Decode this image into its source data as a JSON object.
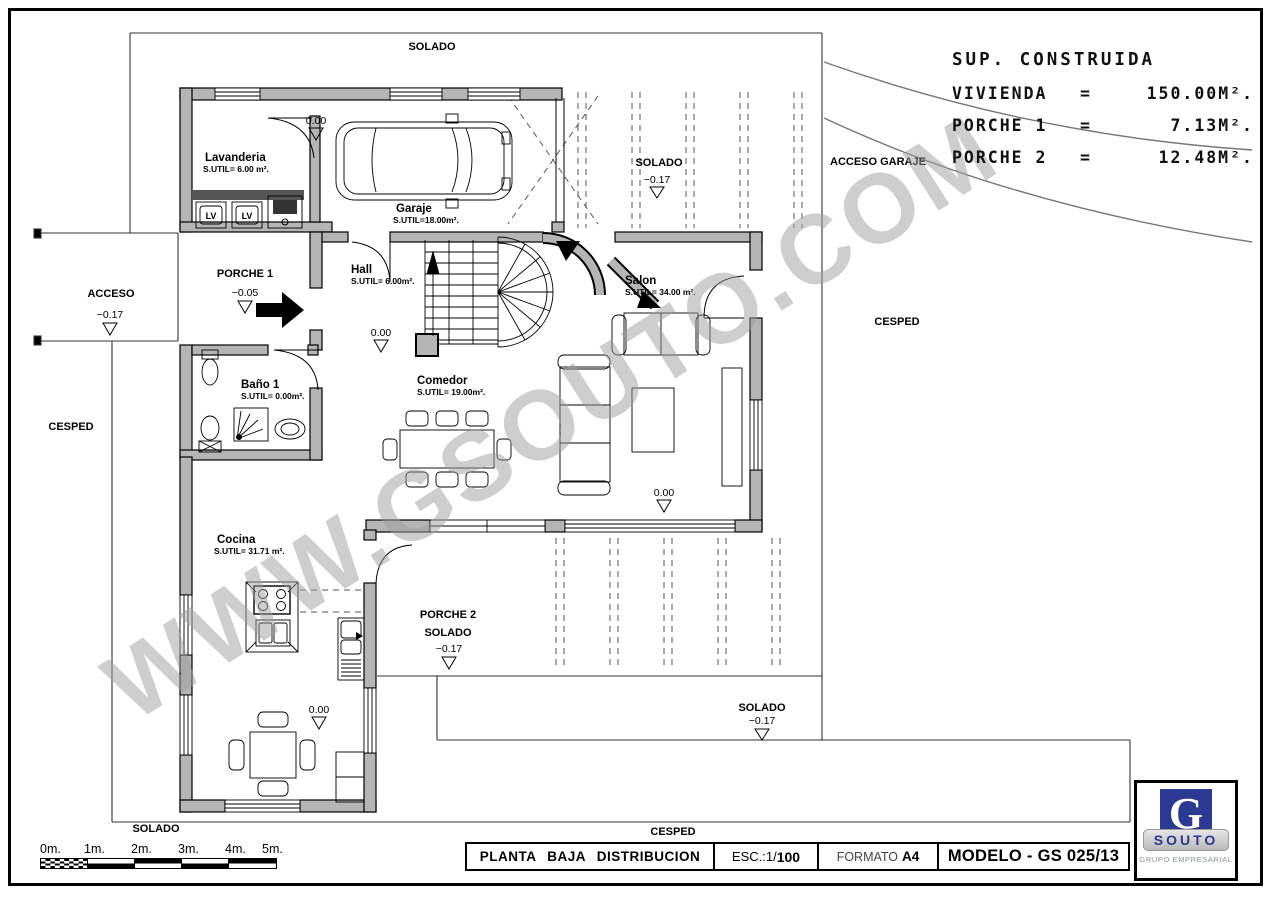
{
  "watermark": "WWW.GSOUTO.COM",
  "summary": {
    "title": "SUP. CONSTRUIDA",
    "rows": [
      {
        "label": "VIVIENDA",
        "eq": "=",
        "value": "150.00M²."
      },
      {
        "label": "PORCHE 1",
        "eq": "=",
        "value": "7.13M²."
      },
      {
        "label": "PORCHE 2",
        "eq": "=",
        "value": "12.48M²."
      }
    ]
  },
  "rooms": {
    "lavanderia": {
      "name": "Lavanderia",
      "area": "S.UTIL= 6.00 m²."
    },
    "garaje": {
      "name": "Garaje",
      "area": "S.UTIL=18.00m²."
    },
    "hall": {
      "name": "Hall",
      "area": "S.UTIL= 6.00m²."
    },
    "salon": {
      "name": "Salon",
      "area": "S.UTIL= 34.00 m²."
    },
    "bano": {
      "name": "Baño 1",
      "area": "S.UTIL= 0.00m²."
    },
    "comedor": {
      "name": "Comedor",
      "area": "S.UTIL= 19.00m²."
    },
    "cocina": {
      "name": "Cocina",
      "area": "S.UTIL= 31.71 m²."
    },
    "porche1": {
      "name": "PORCHE 1",
      "level": "−0.05"
    },
    "porche2": {
      "name": "PORCHE 2",
      "sub": "SOLADO",
      "level": "−0.17"
    }
  },
  "levels": {
    "garaje": "0.00",
    "hall": "0.00",
    "salon": "0.00",
    "cocina": "0.00"
  },
  "site": {
    "solado_top": "SOLADO",
    "ramp": {
      "label": "SOLADO",
      "level": "−0.17"
    },
    "acceso_garaje": "ACCESO GARAJE",
    "acceso": {
      "label": "ACCESO",
      "level": "−0.17"
    },
    "cesped_left": "CESPED",
    "cesped_right": "CESPED",
    "cesped_bottom": "CESPED",
    "solado_left": "SOLADO",
    "solado_bottom_right": {
      "label": "SOLADO",
      "level": "−0.17"
    }
  },
  "appliances": {
    "lv1": "LV",
    "lv2": "LV"
  },
  "scalebar": {
    "ticks": [
      "0m.",
      "1m.",
      "2m.",
      "3m.",
      "4m.",
      "5m."
    ]
  },
  "titleblock": {
    "title": "PLANTA BAJA DISTRIBUCION",
    "esc_label": "ESC.:1/",
    "esc_value": "100",
    "formato_label": "FORMATO",
    "formato_value": "A4",
    "modelo": "MODELO - GS 025/13"
  },
  "logo": {
    "letter": "G",
    "name": "SOUTO",
    "tagline": "GRUPO EMPRESARIAL"
  },
  "colors": {
    "wall": "#b5b5b5",
    "line": "#000000",
    "logo_blue": "#2b3990",
    "watermark": "#9e9e9e"
  }
}
